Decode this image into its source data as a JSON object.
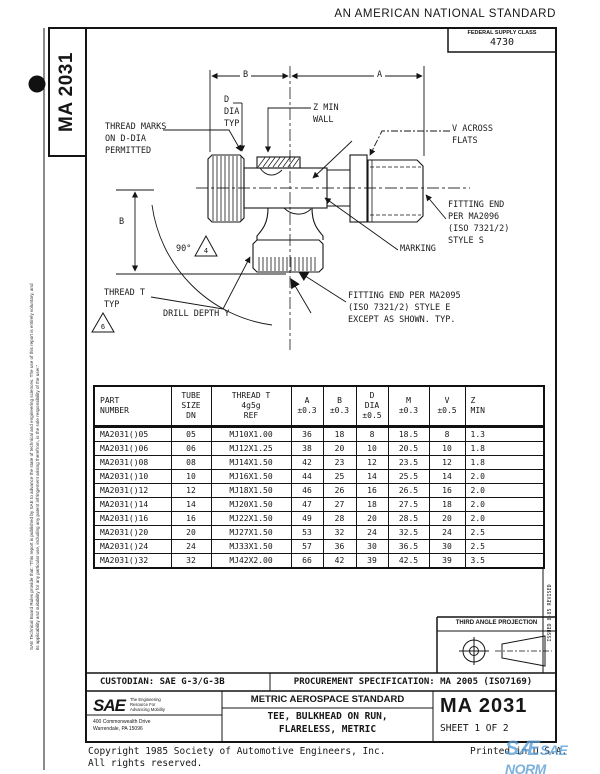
{
  "page": {
    "banner": "AN AMERICAN NATIONAL STANDARD",
    "federal_supply_class_label": "FEDERAL SUPPLY CLASS",
    "federal_supply_class_value": "4730",
    "doc_number_vertical": "MA 2031",
    "side_disclaimer_1": "SAE Technical Board Rules provide that: \"This report is published by SAE to advance the state of technical and engineering sciences. The use of this report is entirely voluntary, and",
    "side_disclaimer_2": "its applicability and suitability for any particular use, including any patent infringement arising therefrom, is the sole responsibility of the user.\"",
    "revision_note": "ISSUED  8-85          REVISED"
  },
  "drawing": {
    "labels": {
      "thread_marks": "THREAD MARKS\nON D-DIA\nPERMITTED",
      "d_dia": "D\nDIA\nTYP",
      "z_min": "Z MIN\nWALL",
      "v_across": "V ACROSS\nFLATS",
      "fitting_end_s": "FITTING END\nPER MA2096\n(ISO 7321/2)\nSTYLE S",
      "marking": "MARKING",
      "fitting_end_e": "FITTING END PER MA2095\n(ISO 7321/2) STYLE E\nEXCEPT AS SHOWN.  TYP.",
      "thread_t": "THREAD T\nTYP",
      "drill_depth": "DRILL DEPTH Y",
      "angle_90": "90°",
      "dim_a": "A",
      "dim_b_top": "B",
      "dim_b_left": "B",
      "flag_4": "4",
      "flag_6": "6"
    }
  },
  "table": {
    "headers": [
      "PART\nNUMBER",
      "TUBE\nSIZE\nDN",
      "THREAD T\n4g5g\nREF",
      "A\n±0.3",
      "B\n±0.3",
      "D\nDIA\n±0.5",
      "M\n±0.3",
      "V\n±0.5",
      "Z\nMIN"
    ],
    "rows": [
      [
        "MA2031()05",
        "05",
        "MJ10X1.00",
        "36",
        "18",
        "8",
        "18.5",
        "8",
        "1.3"
      ],
      [
        "MA2031()06",
        "06",
        "MJ12X1.25",
        "38",
        "20",
        "10",
        "20.5",
        "10",
        "1.8"
      ],
      [
        "MA2031()08",
        "08",
        "MJ14X1.50",
        "42",
        "23",
        "12",
        "23.5",
        "12",
        "1.8"
      ],
      [
        "MA2031()10",
        "10",
        "MJ16X1.50",
        "44",
        "25",
        "14",
        "25.5",
        "14",
        "2.0"
      ],
      [
        "MA2031()12",
        "12",
        "MJ18X1.50",
        "46",
        "26",
        "16",
        "26.5",
        "16",
        "2.0"
      ],
      [
        "MA2031()14",
        "14",
        "MJ20X1.50",
        "47",
        "27",
        "18",
        "27.5",
        "18",
        "2.0"
      ],
      [
        "MA2031()16",
        "16",
        "MJ22X1.50",
        "49",
        "28",
        "20",
        "28.5",
        "20",
        "2.0"
      ],
      [
        "MA2031()20",
        "20",
        "MJ27X1.50",
        "53",
        "32",
        "24",
        "32.5",
        "24",
        "2.5"
      ],
      [
        "MA2031()24",
        "24",
        "MJ33X1.50",
        "57",
        "36",
        "30",
        "36.5",
        "30",
        "2.5"
      ],
      [
        "MA2031()32",
        "32",
        "MJ42X2.00",
        "66",
        "42",
        "39",
        "42.5",
        "39",
        "3.5"
      ]
    ]
  },
  "projection": {
    "label": "THIRD ANGLE PROJECTION"
  },
  "footer": {
    "custodian": "CUSTODIAN:  SAE G-3/G-3B",
    "procurement": "PROCUREMENT SPECIFICATION:  MA 2005 (ISO7169)",
    "sae_logo": "SAE",
    "sae_tagline": "The Engineering\nResource For\nAdvancing Mobility",
    "sae_address": "400 Commonwealth Drive\nWarrendale, PA  15096",
    "standard_type": "METRIC AEROSPACE STANDARD",
    "title": "TEE, BULKHEAD ON RUN,\nFLARELESS, METRIC",
    "doc_number": "MA 2031",
    "sheet": "SHEET 1 OF 2",
    "copyright": "Copyright 1985 Society of Automotive Engineers, Inc.\nAll rights reserved.",
    "printed": "Printed in U.S.A.",
    "watermark_big": "SÆ",
    "watermark_text": "SAE NORM",
    "watermark_sub": "INTERNATIONAL"
  }
}
